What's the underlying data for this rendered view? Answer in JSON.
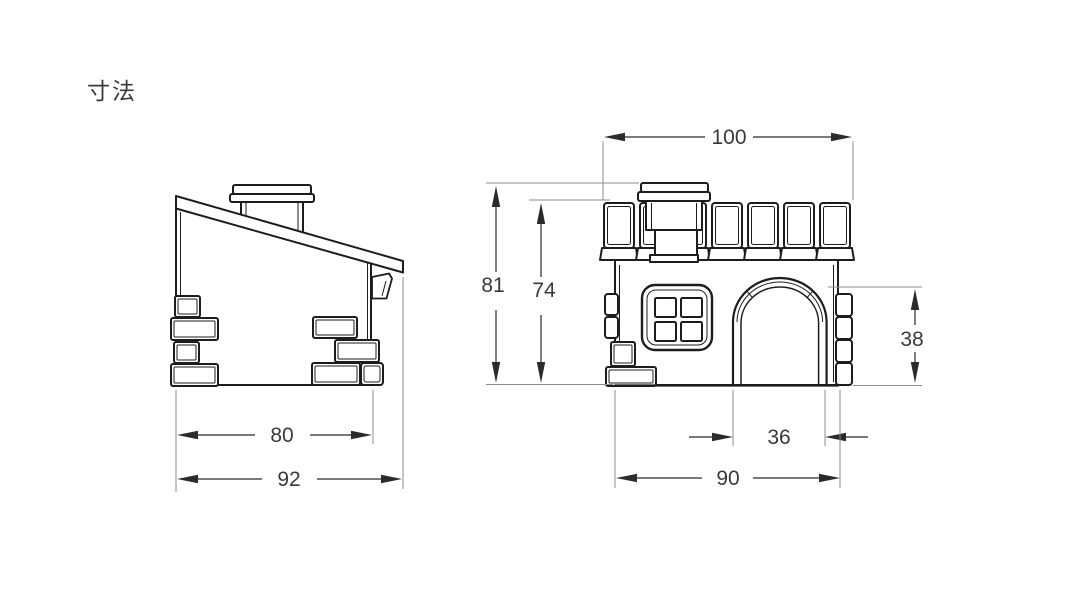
{
  "title": "寸法",
  "colors": {
    "background": "#ffffff",
    "line": "#1d1d1d",
    "dimension": "#2b2b2b",
    "extension": "#8c8c8c",
    "text": "#3a3a3a"
  },
  "dimensions": {
    "side_view": {
      "body_width": "80",
      "overall_width": "92"
    },
    "front_view": {
      "roof_width": "100",
      "overall_height": "81",
      "wall_height": "74",
      "door_height": "38",
      "door_width": "36",
      "body_width": "90"
    }
  }
}
